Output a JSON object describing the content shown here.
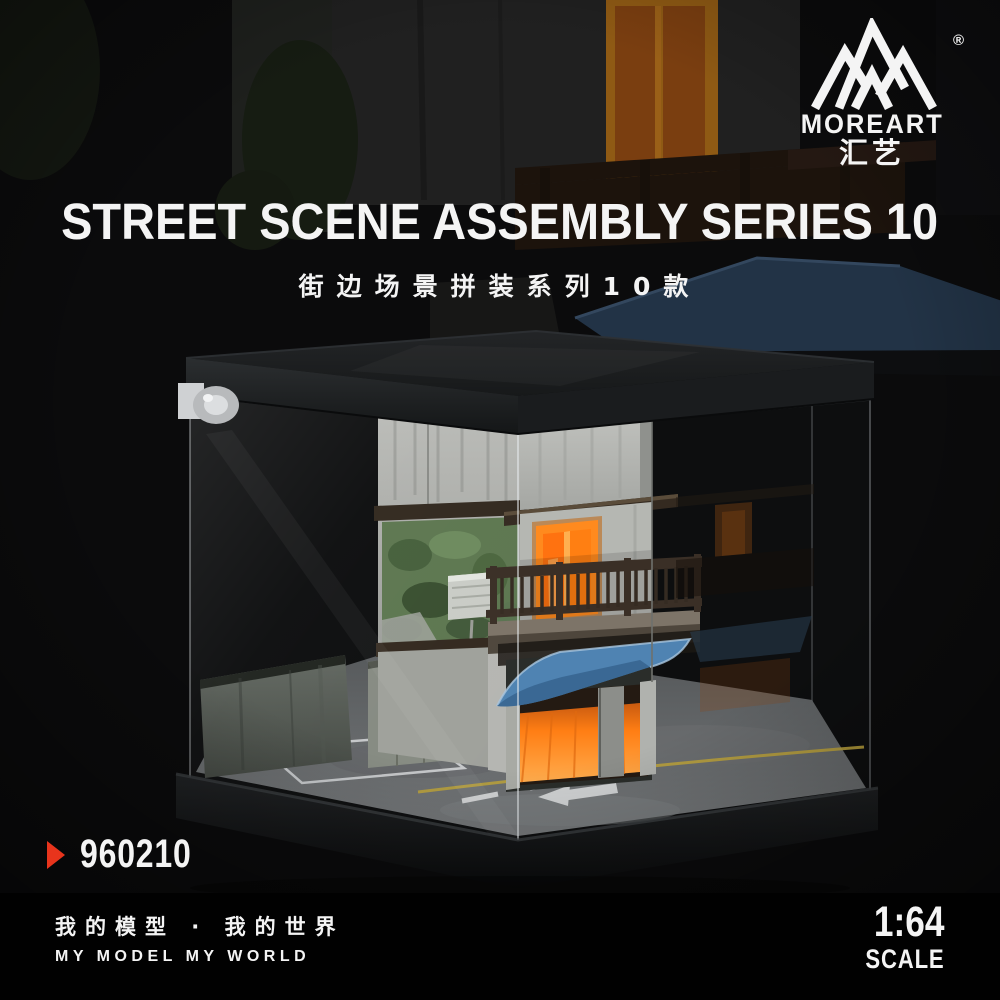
{
  "logo": {
    "brand": "MOREART",
    "brand_cn": "汇艺",
    "registered": "®",
    "icon": "moreart-mountain-logo"
  },
  "header": {
    "title": "STREET SCENE ASSEMBLY SERIES 10",
    "subtitle_cn": "街边场景拼装系列10款"
  },
  "product": {
    "code": "960210",
    "marker_icon": "red-arrow-icon"
  },
  "footer": {
    "slogan_cn": "我的模型 · 我的世界",
    "slogan_en": "MY MODEL MY WORLD",
    "scale_ratio": "1:64",
    "scale_label": "SCALE"
  },
  "colors": {
    "accent_red": "#e8341c",
    "window_orange": "#ff8a1e",
    "garage_orange": "#ff7e14",
    "awning_blue": "#4f83b2",
    "awning_blue_bg": "#223346",
    "text_white": "#f4f4f4",
    "case_black": "#16181a",
    "concrete_gray": "#b5b7b2",
    "ivy_green": "#5d7750",
    "road_yellow": "#b9a13c"
  }
}
